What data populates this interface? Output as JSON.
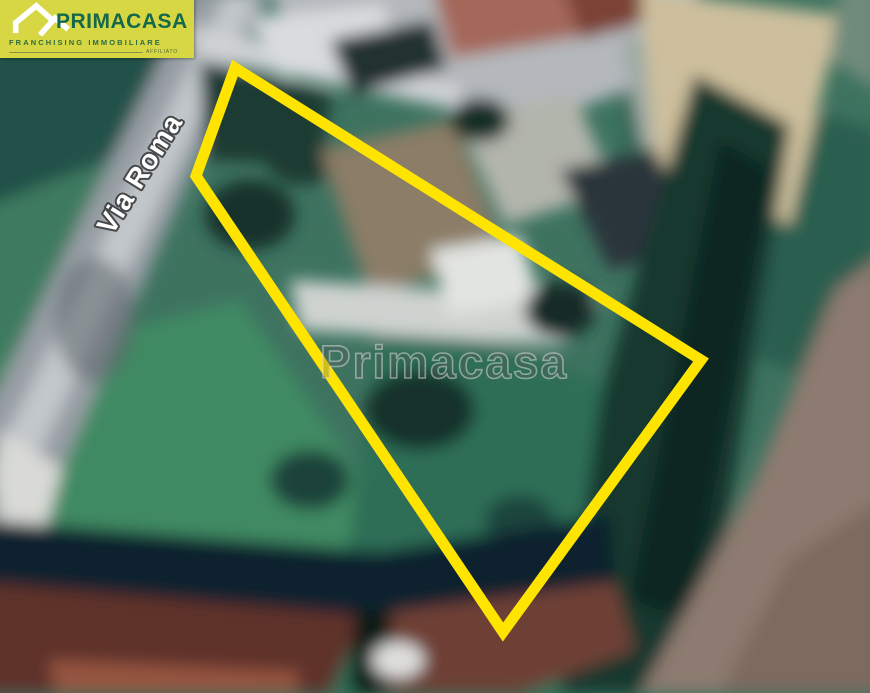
{
  "window": {
    "width": 870,
    "height": 693
  },
  "logo": {
    "brand": "PRIMACASA",
    "tagline": "FRANCHISING IMMOBILIARE",
    "affiliate_label": "AFFILIATO",
    "icon": "double-roof-house-icon",
    "bg_color": "#d6d743",
    "brand_color": "#15684a"
  },
  "map": {
    "kind": "satellite-aerial-photo",
    "street_label": "Via Roma",
    "watermark_text": "Primacasa",
    "watermark_color": "#c8c8c8",
    "parcel_outline": {
      "shape": "quadrilateral",
      "color": "#ffe400",
      "points": "235,68 196,176 503,632 701,360"
    }
  }
}
